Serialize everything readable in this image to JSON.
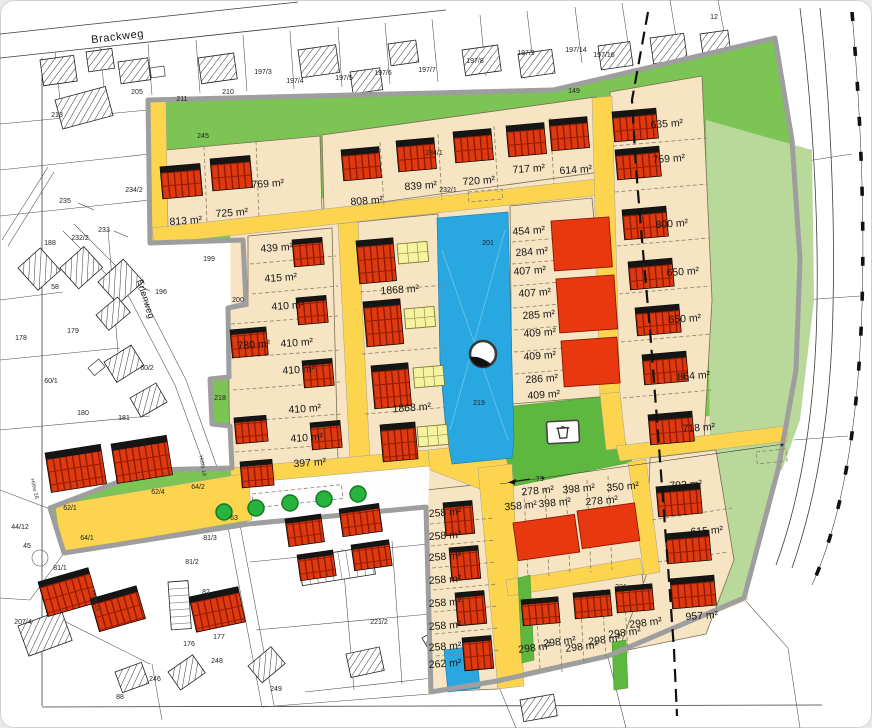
{
  "map": {
    "streets": {
      "brackweg": "Brackweg",
      "erlenweg": "Erlenweg"
    },
    "areas": {
      "a813": "813 m²",
      "a725": "725 m²",
      "a769": "769 m²",
      "a808": "808 m²",
      "a839": "839 m²",
      "a720": "720 m²",
      "a717": "717 m²",
      "a614": "614 m²",
      "a439": "439 m²",
      "a415": "415 m²",
      "a410_1": "410 m²",
      "a780": "780 m²",
      "a410_2": "410 m²",
      "a410_3": "410 m²",
      "a410_4": "410 m²",
      "a410_5": "410 m²",
      "a397": "397 m²",
      "a1868_1": "1868 m²",
      "a1868_2": "1868 m²",
      "a454": "454 m²",
      "a284": "284 m²",
      "a407_1": "407 m²",
      "a407_2": "407 m²",
      "a285": "285 m²",
      "a409_1": "409 m²",
      "a409_2": "409 m²",
      "a286": "286 m²",
      "a409_3": "409 m²",
      "a635": "635 m²",
      "a759": "759 m²",
      "a800": "800 m²",
      "a650_1": "650 m²",
      "a650_2": "650 m²",
      "a864": "864 m²",
      "a718": "718 m²",
      "a793": "793 m²",
      "a615": "615 m²",
      "a957": "957 m²",
      "a278_1": "278 m²",
      "a398_1": "398 m²",
      "a350": "350 m²",
      "a358": "358 m²",
      "a398_2": "398 m²",
      "a278_2": "278 m²",
      "a258_1": "258 m²",
      "a258_2": "258 m²",
      "a258_3": "258 m²",
      "a258_4": "258 m²",
      "a258_5": "258 m²",
      "a258_6": "258 m²",
      "a258_7": "258 m²",
      "a262": "262 m²",
      "a298_1": "298 m²",
      "a298_2": "298 m²",
      "a298_3": "298 m²",
      "a298_4": "298 m²",
      "a298_5": "298 m²",
      "a298_6": "298 m²"
    },
    "parcels": {
      "p213": "213",
      "p205": "205",
      "p211": "211",
      "p210": "210",
      "p197_3": "197/3",
      "p197_4": "197/4",
      "p197_5": "197/5",
      "p197_6": "197/6",
      "p197_7": "197/7",
      "p197_8": "197/8",
      "p197_9": "197/9",
      "p197_14": "197/14",
      "p197_16": "197/16",
      "p12": "12",
      "p149": "149",
      "p245": "245",
      "p234_2": "234/2",
      "p235": "235",
      "p233": "233",
      "p232_2": "232/2",
      "p188": "188",
      "p58": "58",
      "p199": "199",
      "p196": "196",
      "p200": "200",
      "p179": "179",
      "p178": "178",
      "p60_2": "60/2",
      "p60_1": "60/1",
      "p180": "180",
      "p181": "181",
      "p218": "218",
      "p234_1": "234/1",
      "p232_1": "232/1",
      "p201": "201",
      "p219": "219",
      "p44_12": "44/12",
      "p45": "45",
      "p62_1": "62/1",
      "p62_4": "62/4",
      "p64_2": "64/2",
      "p64_1": "64/1",
      "p63": "63",
      "p81_3": "81/3",
      "p81_2": "81/2",
      "p81_1": "81/1",
      "p207_4": "207/4",
      "p82": "82",
      "p176": "176",
      "p177": "177",
      "p88": "88",
      "p246": "246",
      "p248": "248",
      "p249": "249",
      "p221_2": "221/2",
      "p221": "221"
    },
    "annotations": {
      "length_73": "73",
      "hoehe_16": "Höhe 16",
      "hoehe_18": "Höhe 18",
      "hoehe_19": "Höhe 19"
    }
  }
}
